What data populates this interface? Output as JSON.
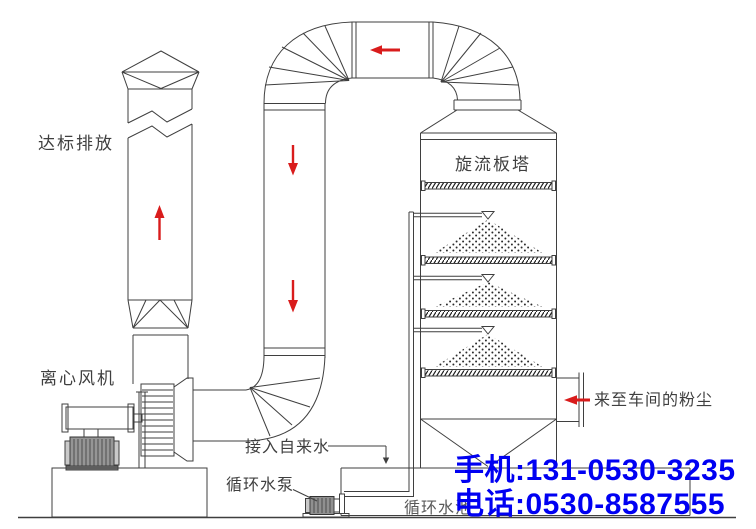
{
  "labels": {
    "emission": "达标排放",
    "fan": "离心风机",
    "tower": "旋流板塔",
    "dust_inlet": "来至车间的粉尘",
    "tap_water": "接入自来水",
    "pump": "循环水泵",
    "pool": "循环水池"
  },
  "contact": {
    "mobile": "手机:131-0530-3235",
    "phone": "电话:0530-8587555",
    "color": "#0000f2"
  },
  "colors": {
    "line": "#3f3f3f",
    "arrow": "#d91c1c",
    "background": "#ffffff"
  },
  "arrows": {
    "stack": "up",
    "top_duct": "left",
    "down_duct_upper": "down",
    "down_duct_lower": "down",
    "tower_inlet": "left"
  }
}
